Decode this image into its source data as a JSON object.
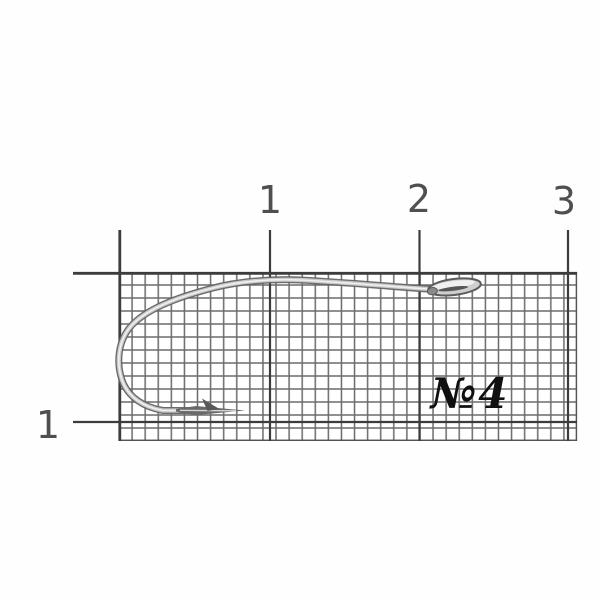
{
  "scene": {
    "subject": "fishing-hook-on-graph-paper",
    "paper_color": "#ffffff"
  },
  "ruler": {
    "top_labels": [
      "1",
      "2",
      "3"
    ],
    "side_labels": [
      "1"
    ],
    "digit_color": "#4f4f4f",
    "major_line_color": "#3c3c3c"
  },
  "grid": {
    "fine_line_color": "#4a4a4a",
    "cells_per_unit_note": "fine millimeter cells, heavier centimeter lines"
  },
  "hook": {
    "size_label": "№4",
    "label_color": "#101010",
    "wire_edge_color": "#646464",
    "wire_body_color": "#c9c9c9",
    "wire_highlight_color": "#f0f0f0"
  }
}
